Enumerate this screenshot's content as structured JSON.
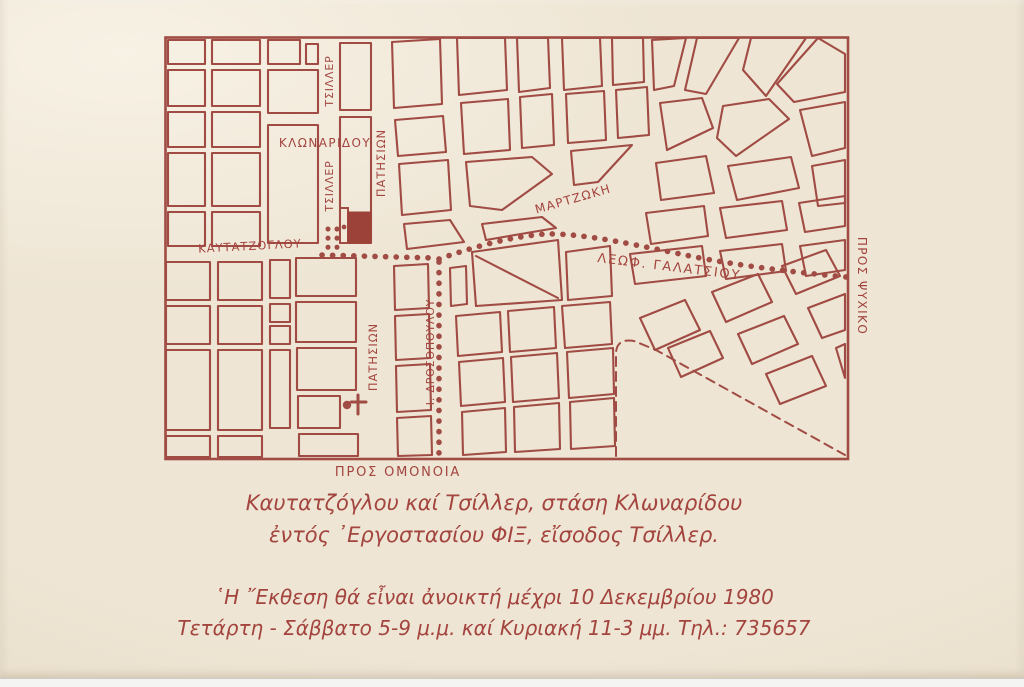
{
  "colors": {
    "accent": "#a04b43",
    "accent_text": "#a3443e",
    "fix_fill": "#9c4238",
    "paper": "#eee5d4"
  },
  "map": {
    "street_labels": {
      "klonaridou": "ΚΛΩΝΑΡΙΔΟΥ",
      "tsiller_upper": "ΤΣΙΛΛΕΡ",
      "tsiller_lower": "ΤΣΙΛΛΕΡ",
      "patision_upper": "ΠΑΤΗΣΙΩΝ",
      "patision_lower": "ΠΑΤΗΣΙΩΝ",
      "martzoki": "ΜΑΡΤΖΩΚΗ",
      "kautatzoglou": "ΚΑΥΤΑΤΖΟΓΛΟΥ",
      "leof_galatsiou": "ΛΕΩΦ. ΓΑΛΑΤΣΙΟΥ",
      "drosopoulou": "Ι. ΔΡΟΣΟΠΟΥΛΟΥ",
      "pros_psychiko": "ΠΡΟΣ ΨΥΧΙΚΟ",
      "pros_omonoia": "ΠΡΟΣ ΟΜΟΝΟΙΑ"
    }
  },
  "captions": {
    "address_line1": "Καυτατζόγλου καί Τσίλλερ, στάση Κλωναρίδου",
    "address_line2": "ἐντός ᾿Εργοστασίου ΦΙΞ, εἴσοδος Τσίλλερ.",
    "info_line1": "῾Η ῎Εκθεση θά εἶναι ἀνοικτή μέχρι 10 Δεκεμβρίου 1980",
    "info_line2": "Τετάρτη - Σάββατο 5-9 μ.μ. καί Κυριακή 11-3 μμ. Τηλ.: 735657"
  }
}
